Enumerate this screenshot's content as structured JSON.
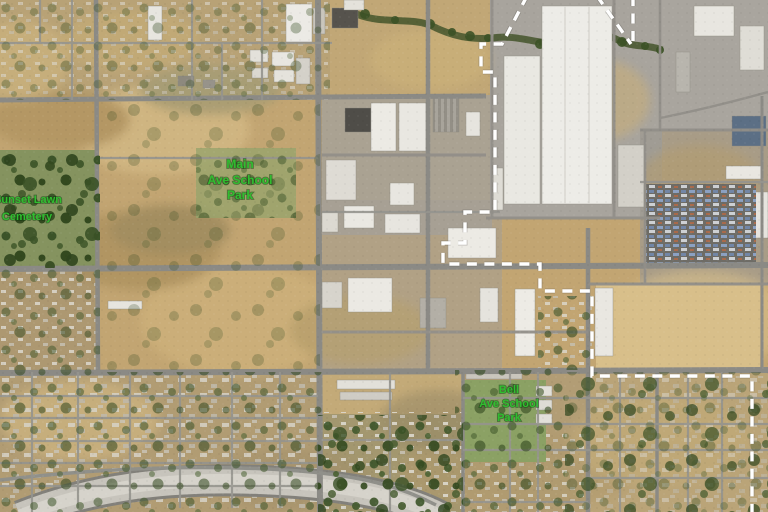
{
  "map": {
    "view": "satellite-aerial",
    "labels": {
      "cemetery": {
        "line1": "Sunset Lawn",
        "line2": "Cemetery"
      },
      "main_park": {
        "line1": "Main",
        "line2": "Ave School",
        "line3": "Park"
      },
      "bell_park": {
        "line1": "Bell",
        "line2": "Ave School",
        "line3": "Park"
      }
    },
    "colors": {
      "label_green": "#2fbe2f",
      "boundary_white": "#ffffff",
      "terrain_tan": "#c2a572",
      "road_gray": "#8b8a85",
      "building_white": "#eae8e2",
      "canal_gray": "#c8c5bd",
      "tree_green": "#3c5429"
    },
    "boundary_style": "dashed"
  }
}
